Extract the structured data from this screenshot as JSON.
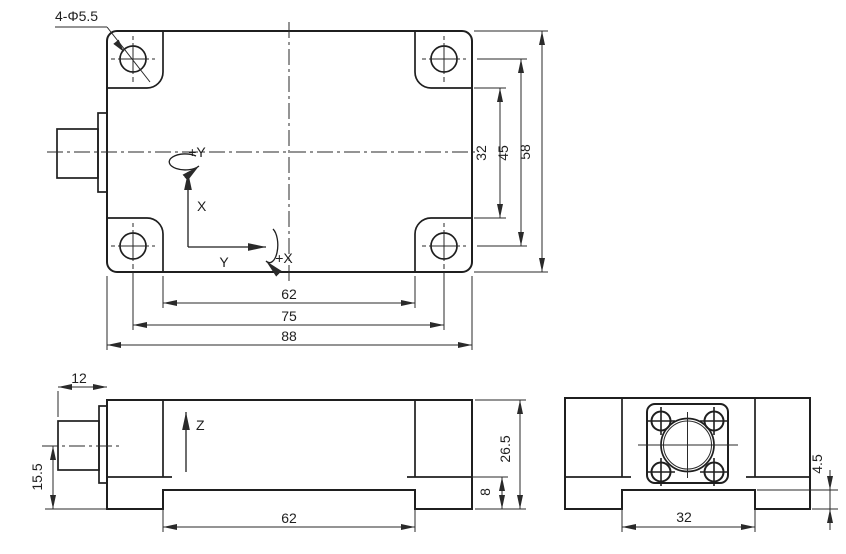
{
  "drawing": {
    "background_color": "#ffffff",
    "line_color": "#1f1f1f",
    "callout": "4-Φ5.5",
    "axes": {
      "x": "X",
      "y": "Y",
      "z": "Z",
      "rot_x": "+X",
      "rot_y": "+Y"
    },
    "top_view": {
      "dim_recess_length": "62",
      "dim_hole_spacing_x": "75",
      "dim_overall_length": "88",
      "dim_recess_width": "32",
      "dim_hole_spacing_y": "45",
      "dim_overall_width": "58"
    },
    "front_view": {
      "dim_connector_length": "12",
      "dim_connector_axis_height": "15.5",
      "dim_overall_height": "26.5",
      "dim_base_height": "8",
      "dim_recess_length": "62"
    },
    "side_view": {
      "dim_recess_width": "32",
      "dim_recess_depth": "4.5"
    }
  }
}
